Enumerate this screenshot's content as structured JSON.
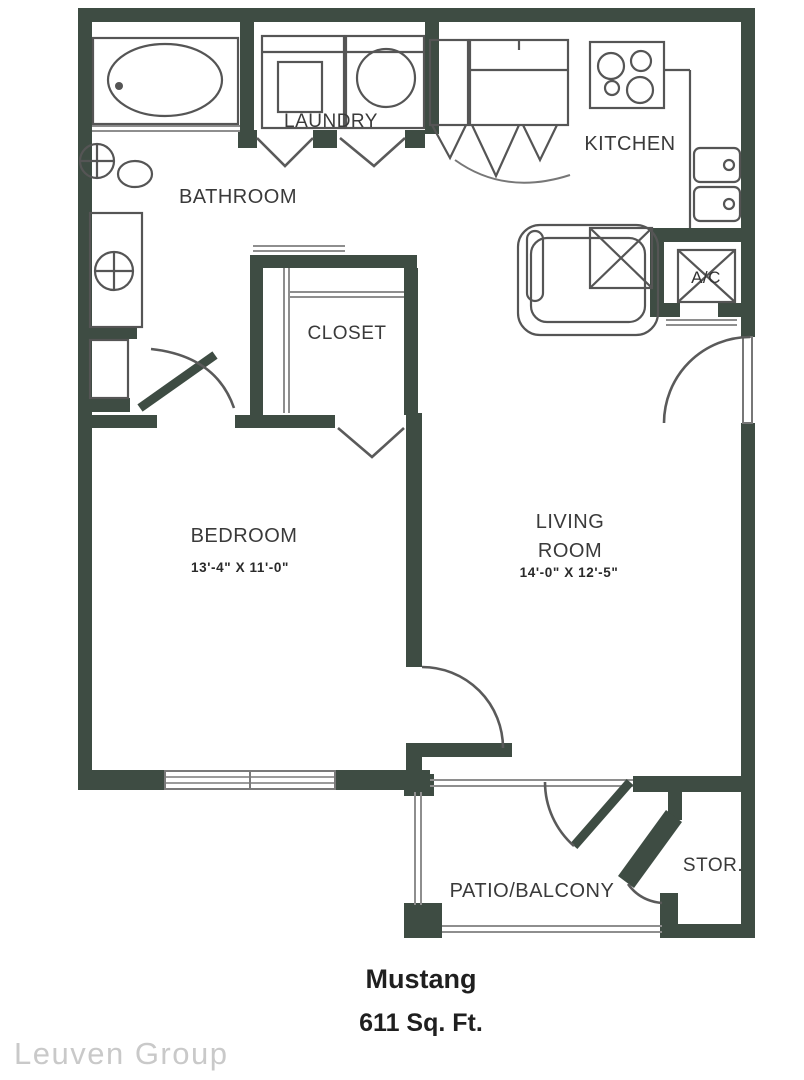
{
  "colors": {
    "wall": "#3e4c43",
    "fixture-line": "#555555",
    "light-line": "#8e8e8e",
    "label-text": "#3a3a3a",
    "title-text": "#1f1f1f",
    "watermark-text": "#c9c9c9",
    "background": "#ffffff"
  },
  "rooms": {
    "laundry": {
      "label": "LAUNDRY"
    },
    "bathroom": {
      "label": "BATHROOM"
    },
    "kitchen": {
      "label": "KITCHEN"
    },
    "ac_closet": {
      "label": "A/C"
    },
    "closet": {
      "label": "CLOSET"
    },
    "bedroom": {
      "label": "BEDROOM",
      "dimensions": "13'-4\" X 11'-0\""
    },
    "living_room": {
      "label_line1": "LIVING",
      "label_line2": "ROOM",
      "dimensions": "14'-0\" X 12'-5\""
    },
    "patio": {
      "label": "PATIO/BALCONY"
    },
    "storage": {
      "label": "STOR."
    }
  },
  "plan": {
    "name": "Mustang",
    "area": "611 Sq. Ft."
  },
  "watermark": {
    "text": "Leuven Group"
  }
}
